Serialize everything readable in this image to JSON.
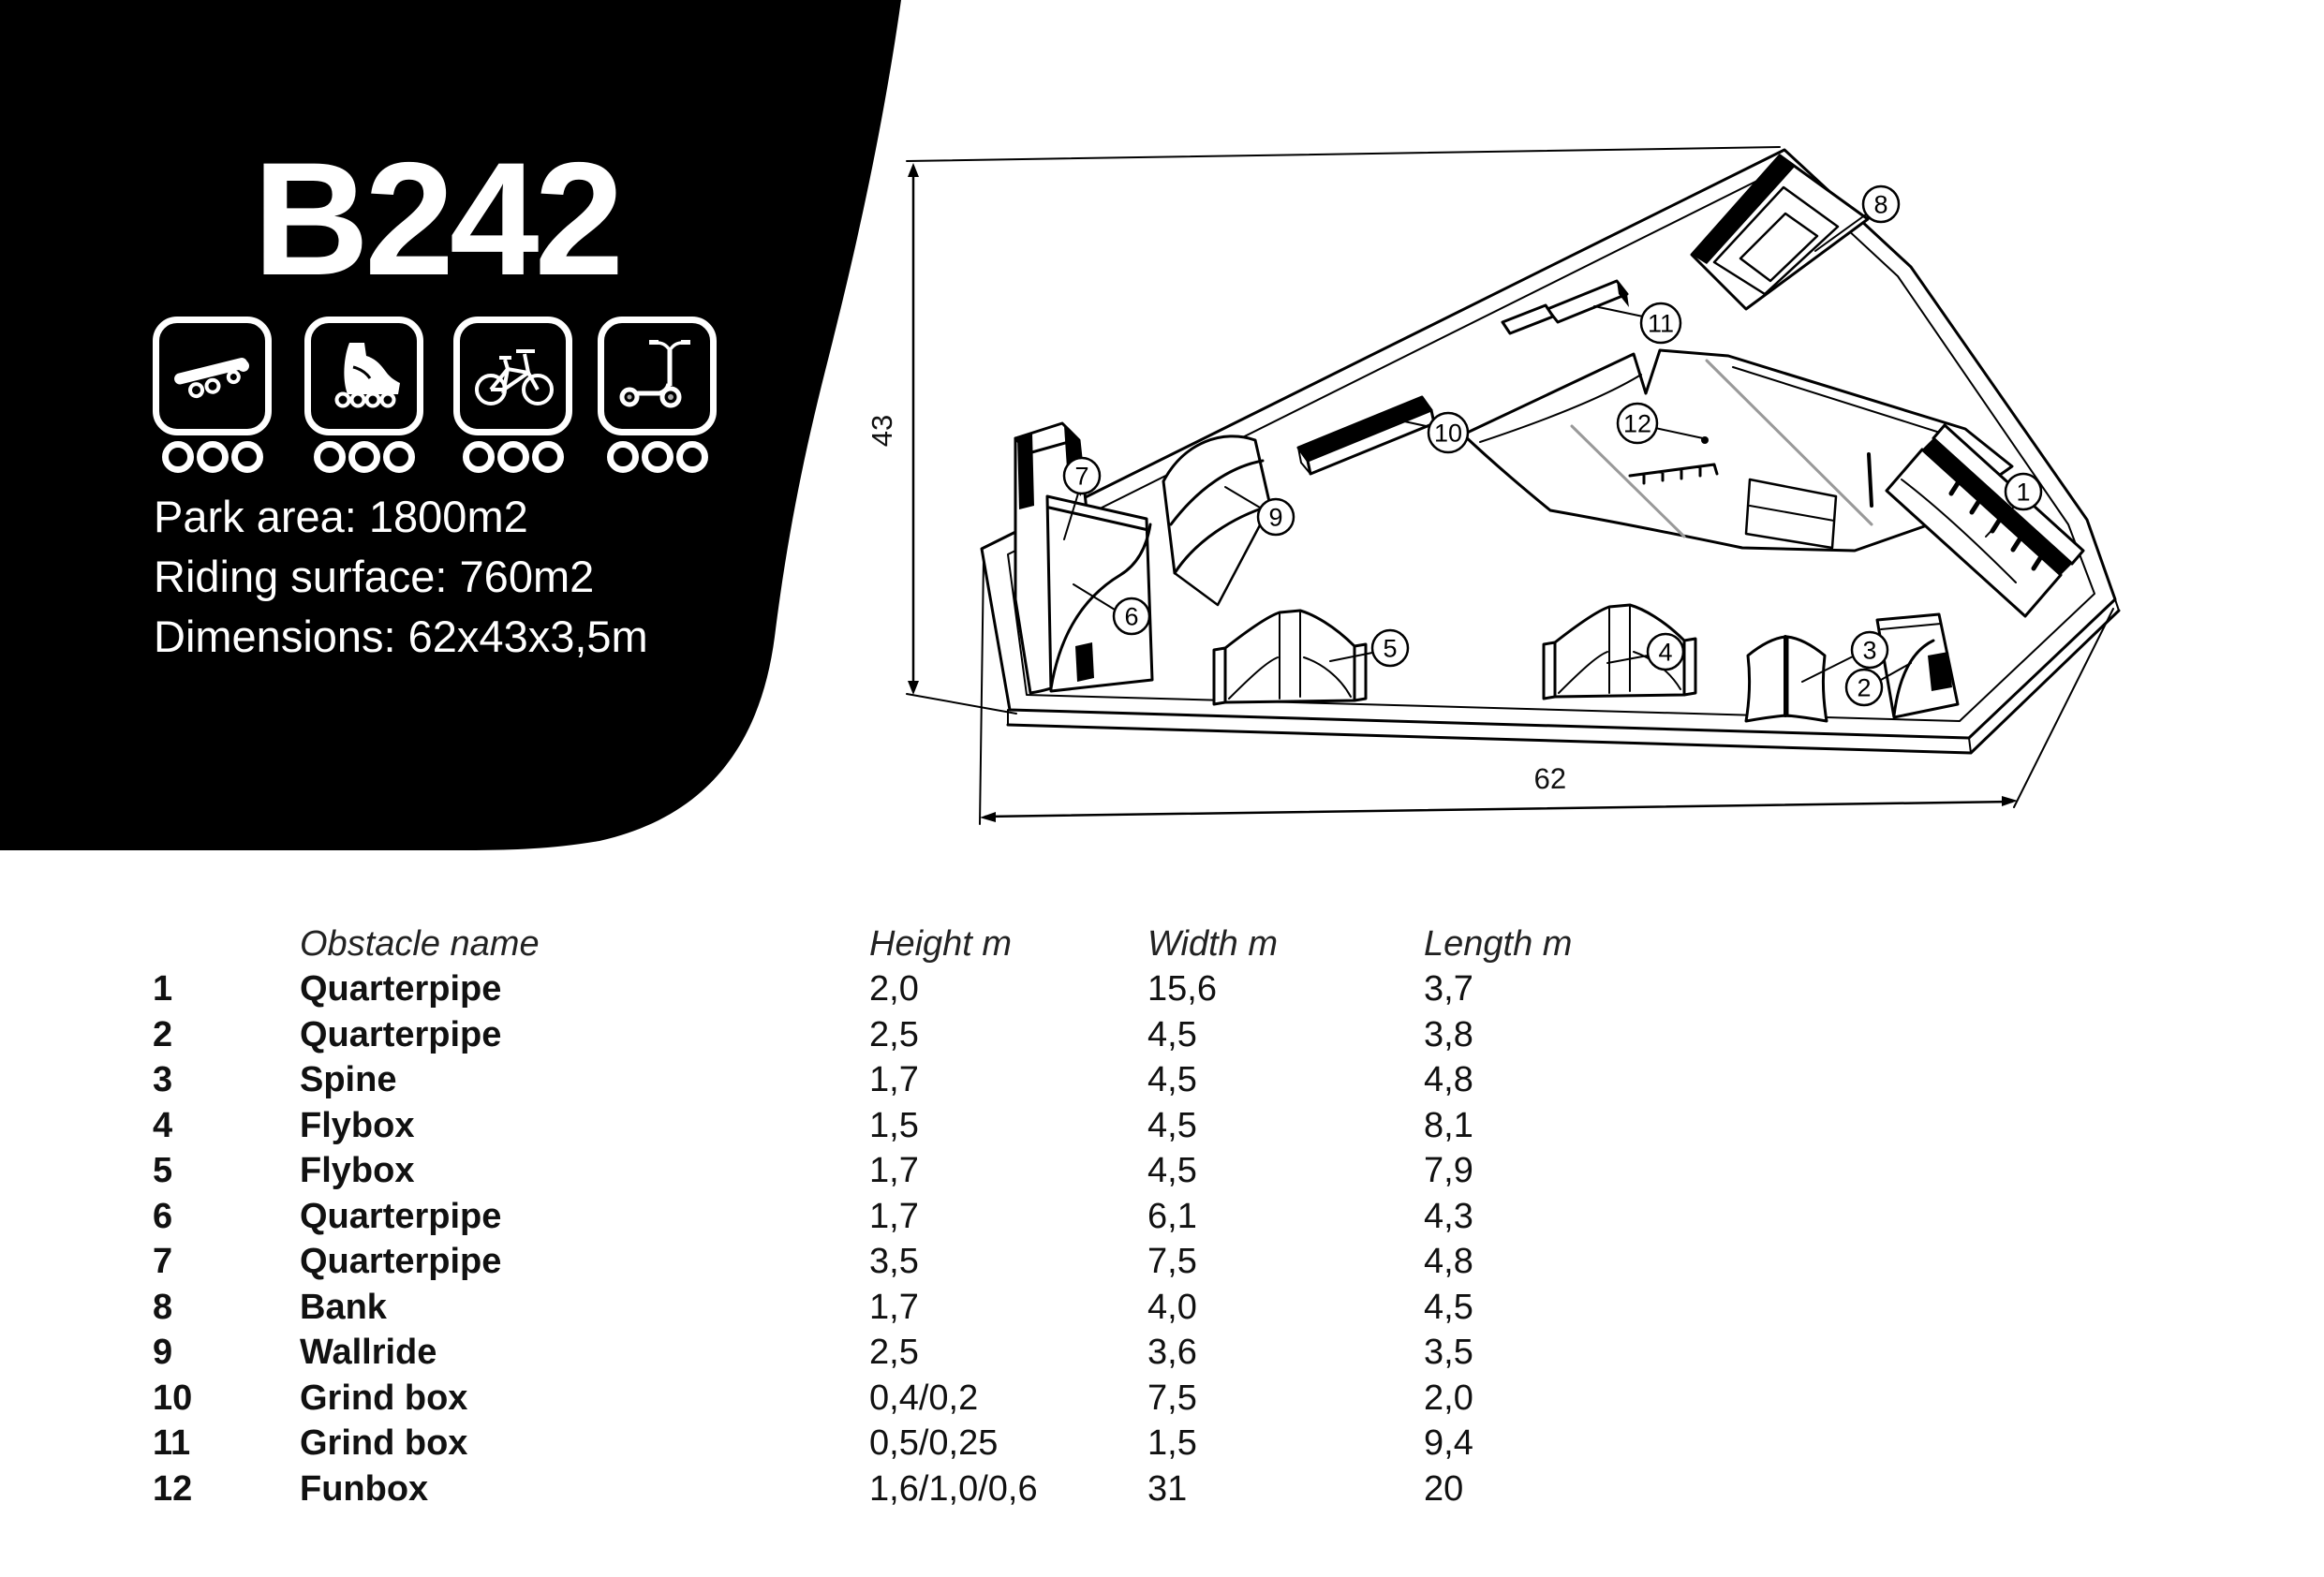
{
  "header": {
    "title": "B242"
  },
  "disciplines": [
    {
      "name": "skateboard",
      "rating": 3
    },
    {
      "name": "inline-skates",
      "rating": 3
    },
    {
      "name": "bmx",
      "rating": 3
    },
    {
      "name": "scooter",
      "rating": 3
    }
  ],
  "info": {
    "park_area": "Park area: 1800m2",
    "riding_surface": "Riding surface: 760m2",
    "dimensions": "Dimensions: 62x43x3,5m"
  },
  "drawing": {
    "dim_height": "43",
    "dim_width": "62",
    "callouts": [
      {
        "n": "1"
      },
      {
        "n": "2"
      },
      {
        "n": "3"
      },
      {
        "n": "4"
      },
      {
        "n": "5"
      },
      {
        "n": "6"
      },
      {
        "n": "7"
      },
      {
        "n": "8"
      },
      {
        "n": "9"
      },
      {
        "n": "10"
      },
      {
        "n": "11"
      },
      {
        "n": "12"
      }
    ]
  },
  "table": {
    "headers": {
      "name": "Obstacle name",
      "height": "Height m",
      "width": "Width m",
      "length": "Length m"
    },
    "rows": [
      {
        "no": "1",
        "name": "Quarterpipe",
        "height": "2,0",
        "width": "15,6",
        "length": "3,7"
      },
      {
        "no": "2",
        "name": "Quarterpipe",
        "height": "2,5",
        "width": "4,5",
        "length": "3,8"
      },
      {
        "no": "3",
        "name": "Spine",
        "height": "1,7",
        "width": "4,5",
        "length": "4,8"
      },
      {
        "no": "4",
        "name": "Flybox",
        "height": "1,5",
        "width": "4,5",
        "length": "8,1"
      },
      {
        "no": "5",
        "name": "Flybox",
        "height": "1,7",
        "width": "4,5",
        "length": "7,9"
      },
      {
        "no": "6",
        "name": "Quarterpipe",
        "height": "1,7",
        "width": "6,1",
        "length": "4,3"
      },
      {
        "no": "7",
        "name": "Quarterpipe",
        "height": "3,5",
        "width": "7,5",
        "length": "4,8"
      },
      {
        "no": "8",
        "name": "Bank",
        "height": "1,7",
        "width": "4,0",
        "length": "4,5"
      },
      {
        "no": "9",
        "name": "Wallride",
        "height": "2,5",
        "width": "3,6",
        "length": "3,5"
      },
      {
        "no": "10",
        "name": "Grind box",
        "height": "0,4/0,2",
        "width": "7,5",
        "length": "2,0"
      },
      {
        "no": "11",
        "name": "Grind box",
        "height": "0,5/0,25",
        "width": "1,5",
        "length": "9,4"
      },
      {
        "no": "12",
        "name": "Funbox",
        "height": "1,6/1,0/0,6",
        "width": "31",
        "length": "20"
      }
    ]
  },
  "colors": {
    "panel": "#000000",
    "line": "#000000",
    "background": "#ffffff",
    "accent_gray": "#999999"
  }
}
